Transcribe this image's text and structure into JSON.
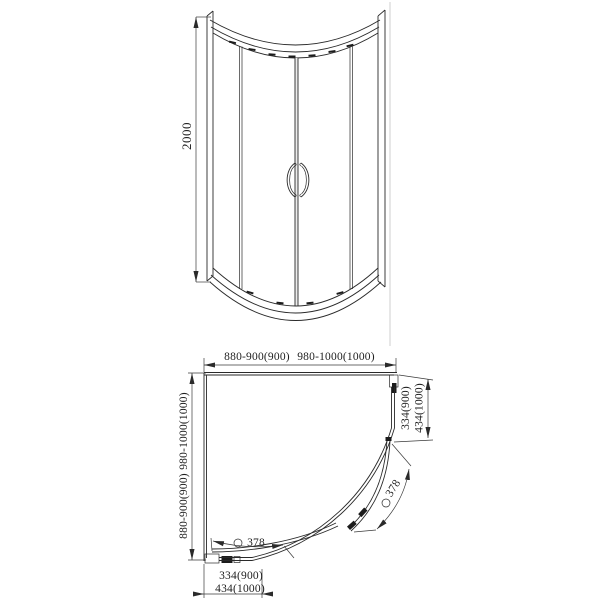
{
  "drawing": {
    "kind": "quadrant-shower-enclosure-technical-drawing",
    "line_color": "#2a2a2a",
    "background": "#ffffff",
    "front": {
      "height_dim": "2000"
    },
    "plan": {
      "width_dim_a": "880-900(900)",
      "width_dim_b": "980-1000(1000)",
      "depth_dim_a": "980-1000(1000)",
      "depth_dim_b": "880-900(900)",
      "right_panel_dim_a": "334(900)",
      "right_panel_dim_b": "434(1000)",
      "bottom_panel_dim_a": "334(900)",
      "bottom_panel_dim_b": "434(1000)",
      "door_dim_bottom": "378",
      "door_dim_right": "378"
    }
  }
}
